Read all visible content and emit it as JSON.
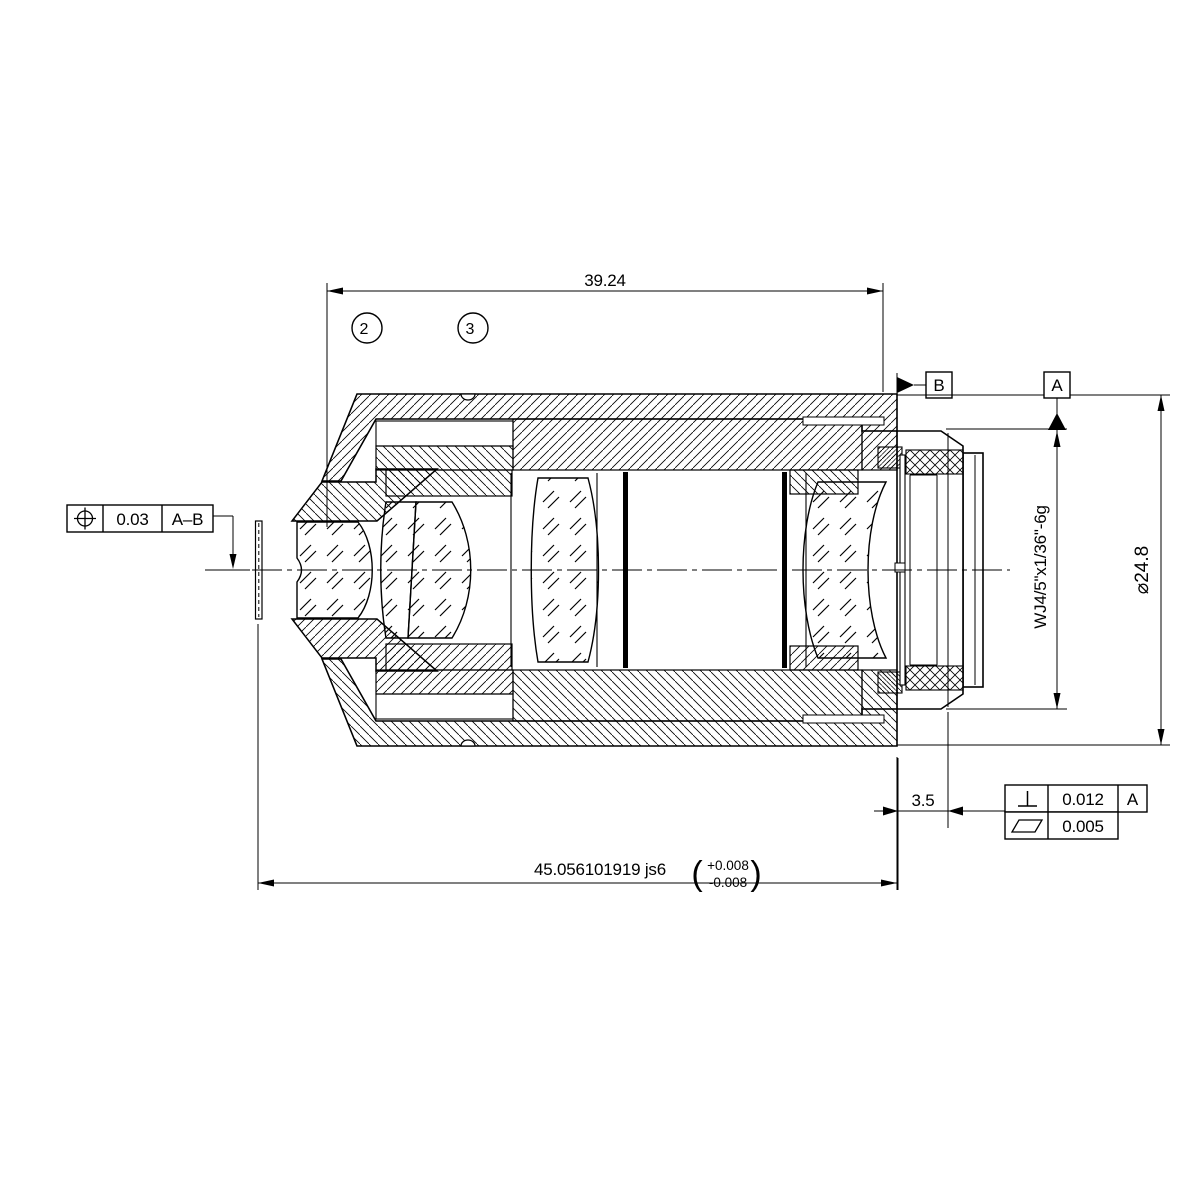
{
  "drawing": {
    "dim_top": {
      "value": "39.24"
    },
    "dim_overall": {
      "value": "45.056101919 js6",
      "tol_open": "(",
      "tol_plus": "+0.008",
      "tol_minus": "-0.008",
      "tol_close": ")"
    },
    "dim_rear": {
      "value": "3.5"
    },
    "dim_diameter": {
      "value": "⌀24.8"
    },
    "thread_callout": {
      "value": "WJ4/5\"x1/36\"-6g"
    },
    "balloons": [
      {
        "label": "2"
      },
      {
        "label": "3"
      }
    ],
    "datum_a": {
      "label": "A"
    },
    "datum_b": {
      "label": "B"
    },
    "fcf_position": {
      "symbol": "position",
      "tolerance": "0.03",
      "datum_refs": "A–B"
    },
    "fcf_perpendicularity": {
      "symbol": "perpendicularity",
      "tolerance": "0.012",
      "datum_refs": "A"
    },
    "fcf_flatness": {
      "symbol": "flatness",
      "tolerance": "0.005"
    }
  }
}
